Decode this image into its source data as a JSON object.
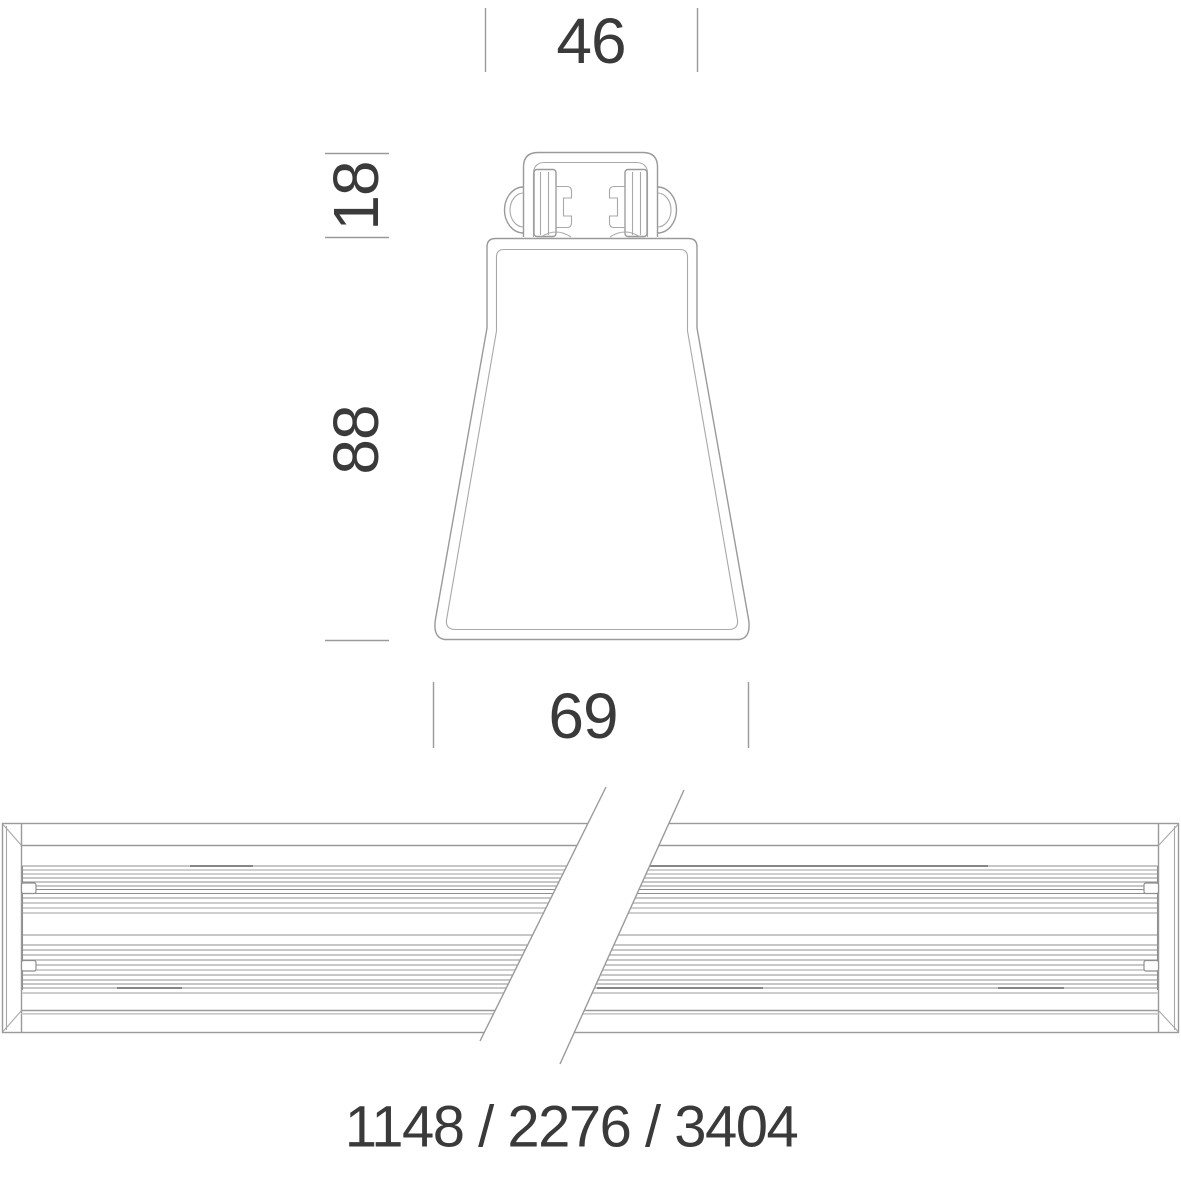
{
  "section_view": {
    "top_width_mm": "46",
    "mount_height_mm": "18",
    "body_height_mm": "88",
    "base_width_mm": "69"
  },
  "length_view": {
    "length_options_mm": "1148 / 2276 / 3404"
  },
  "colors": {
    "line": "#9a9a9a",
    "line_light": "#c8c8c8",
    "line_dark": "#5f5f5f",
    "text": "#3a3a3a",
    "background": "#ffffff"
  }
}
